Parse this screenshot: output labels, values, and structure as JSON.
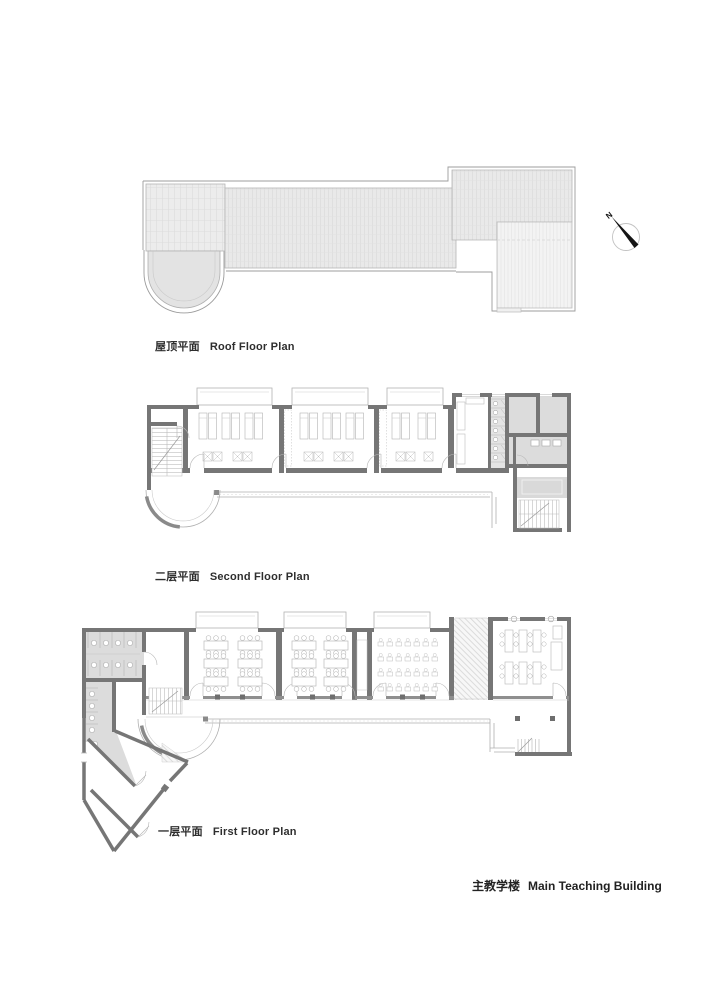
{
  "sheet": {
    "caption_zh": "主教学楼",
    "caption_en": "Main Teaching Building"
  },
  "plans": [
    {
      "id": "roof",
      "zh": "屋顶平面",
      "en": "Roof Floor Plan"
    },
    {
      "id": "second",
      "zh": "二层平面",
      "en": "Second Floor Plan"
    },
    {
      "id": "first",
      "zh": "一层平面",
      "en": "First Floor Plan"
    }
  ],
  "north_arrow": {
    "label": "N"
  },
  "colors": {
    "wall": "#767676",
    "thin_line": "#b0b0b0",
    "room_gray": "#dcdcdc",
    "roof_fill": "#eaeaea",
    "roof_fill_dark": "#e3e3e3",
    "roof_fill_light": "#f3f3f3",
    "text": "#2e2e2e"
  }
}
